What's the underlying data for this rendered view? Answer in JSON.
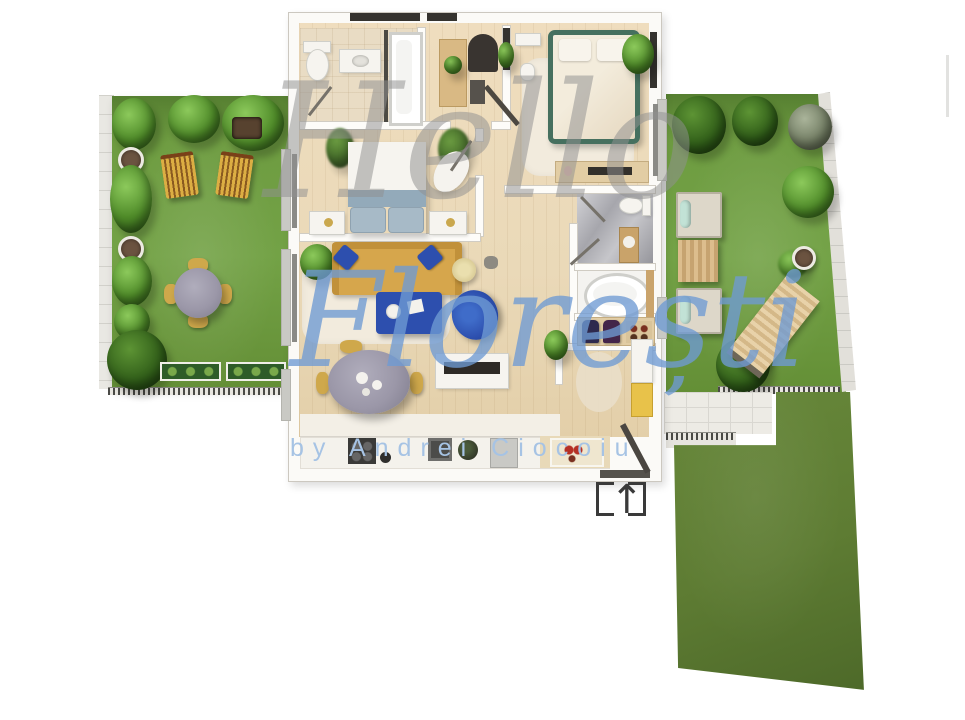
{
  "watermark": {
    "line1": "Hello",
    "line2": "Florești",
    "byline": "by Andrei Ciocoiu"
  },
  "icons": {
    "entrance_arrow": "↑"
  },
  "colors": {
    "background": "#ffffff",
    "lawn": "#6e9c41",
    "lawn_dark": "#5e7c33",
    "wood_floor": "#ead9b8",
    "terrace_tile": "#edebe5",
    "sofa_yellow": "#d6a64c",
    "accent_blue": "#2d4fae",
    "bed_frame_green": "#46705f",
    "bed_blanket_blue": "#93aaba",
    "dining_table_gray": "#9b97a8",
    "marble_gray": "#b4b4ba",
    "watermark_gray": "#919191",
    "watermark_blue": "#6f9bd4",
    "byline_blue": "#a6c3e4",
    "line_dark": "#3a3a3a"
  }
}
